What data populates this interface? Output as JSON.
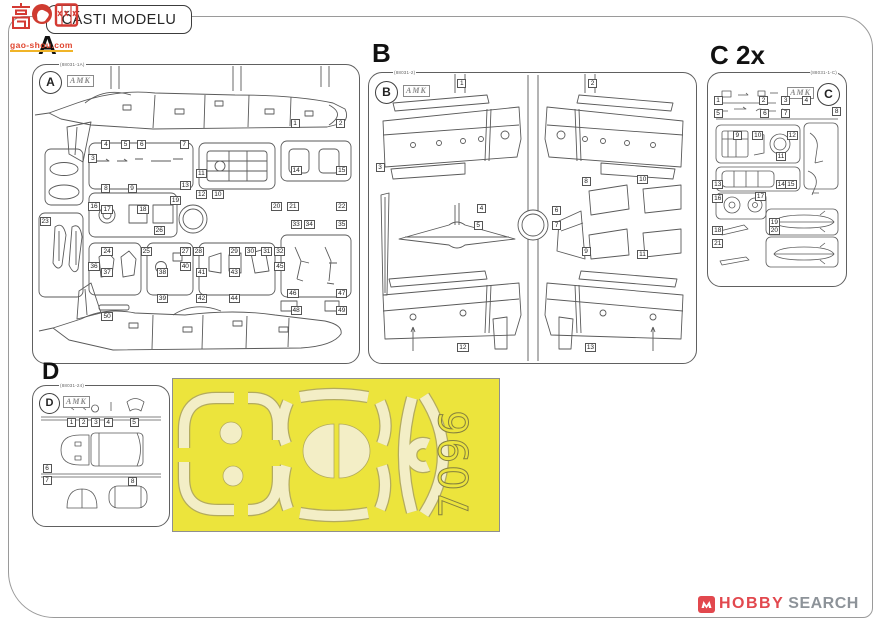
{
  "header": {
    "title": "ČÁSTI MODELU"
  },
  "watermark": {
    "chars": "高手网",
    "site": "gao-shou.com"
  },
  "mask": {
    "number": "7096",
    "color_bg": "#ece43c",
    "color_film": "#f3eec6"
  },
  "footer_logo": {
    "brand_primary": "HOBBY",
    "brand_secondary": "SEARCH",
    "icon": "hobbysearch-red-square-icon",
    "accent": "#e2484e"
  },
  "sprues": [
    {
      "id": "A",
      "label": "A",
      "code": "(88031-1A)",
      "logo": "AMK",
      "parts": [
        {
          "n": "1",
          "x": 79,
          "y": 18
        },
        {
          "n": "2",
          "x": 93,
          "y": 18
        },
        {
          "n": "3",
          "x": 17,
          "y": 30
        },
        {
          "n": "4",
          "x": 21,
          "y": 25
        },
        {
          "n": "5",
          "x": 27,
          "y": 25
        },
        {
          "n": "6",
          "x": 32,
          "y": 25
        },
        {
          "n": "7",
          "x": 45,
          "y": 25
        },
        {
          "n": "8",
          "x": 21,
          "y": 40
        },
        {
          "n": "9",
          "x": 29,
          "y": 40
        },
        {
          "n": "10",
          "x": 55,
          "y": 42
        },
        {
          "n": "11",
          "x": 50,
          "y": 35
        },
        {
          "n": "12",
          "x": 50,
          "y": 42
        },
        {
          "n": "13",
          "x": 45,
          "y": 39
        },
        {
          "n": "14",
          "x": 79,
          "y": 34
        },
        {
          "n": "15",
          "x": 93,
          "y": 34
        },
        {
          "n": "16",
          "x": 17,
          "y": 46
        },
        {
          "n": "17",
          "x": 21,
          "y": 47
        },
        {
          "n": "18",
          "x": 32,
          "y": 47
        },
        {
          "n": "19",
          "x": 42,
          "y": 44
        },
        {
          "n": "20",
          "x": 73,
          "y": 46
        },
        {
          "n": "21",
          "x": 78,
          "y": 46
        },
        {
          "n": "22",
          "x": 93,
          "y": 46
        },
        {
          "n": "23",
          "x": 2,
          "y": 51
        },
        {
          "n": "24",
          "x": 21,
          "y": 61
        },
        {
          "n": "25",
          "x": 33,
          "y": 61
        },
        {
          "n": "26",
          "x": 37,
          "y": 54
        },
        {
          "n": "27",
          "x": 45,
          "y": 61
        },
        {
          "n": "28",
          "x": 49,
          "y": 61
        },
        {
          "n": "29",
          "x": 60,
          "y": 61
        },
        {
          "n": "30",
          "x": 65,
          "y": 61
        },
        {
          "n": "31",
          "x": 70,
          "y": 61
        },
        {
          "n": "32",
          "x": 74,
          "y": 61
        },
        {
          "n": "33",
          "x": 79,
          "y": 52
        },
        {
          "n": "34",
          "x": 83,
          "y": 52
        },
        {
          "n": "35",
          "x": 93,
          "y": 52
        },
        {
          "n": "36",
          "x": 17,
          "y": 66
        },
        {
          "n": "37",
          "x": 21,
          "y": 68
        },
        {
          "n": "38",
          "x": 38,
          "y": 68
        },
        {
          "n": "39",
          "x": 38,
          "y": 77
        },
        {
          "n": "40",
          "x": 45,
          "y": 66
        },
        {
          "n": "41",
          "x": 50,
          "y": 68
        },
        {
          "n": "42",
          "x": 50,
          "y": 77
        },
        {
          "n": "43",
          "x": 60,
          "y": 68
        },
        {
          "n": "44",
          "x": 60,
          "y": 77
        },
        {
          "n": "45",
          "x": 74,
          "y": 66
        },
        {
          "n": "46",
          "x": 78,
          "y": 75
        },
        {
          "n": "47",
          "x": 93,
          "y": 75
        },
        {
          "n": "48",
          "x": 79,
          "y": 81
        },
        {
          "n": "49",
          "x": 93,
          "y": 81
        },
        {
          "n": "50",
          "x": 21,
          "y": 83
        }
      ]
    },
    {
      "id": "B",
      "label": "B",
      "code": "(88031-2)",
      "logo": "AMK",
      "parts": [
        {
          "n": "1",
          "x": 27,
          "y": 2
        },
        {
          "n": "2",
          "x": 67,
          "y": 2
        },
        {
          "n": "3",
          "x": 2,
          "y": 31
        },
        {
          "n": "4",
          "x": 33,
          "y": 45
        },
        {
          "n": "5",
          "x": 32,
          "y": 51
        },
        {
          "n": "6",
          "x": 56,
          "y": 46
        },
        {
          "n": "7",
          "x": 56,
          "y": 51
        },
        {
          "n": "8",
          "x": 65,
          "y": 36
        },
        {
          "n": "9",
          "x": 65,
          "y": 60
        },
        {
          "n": "10",
          "x": 82,
          "y": 35
        },
        {
          "n": "11",
          "x": 82,
          "y": 61
        },
        {
          "n": "12",
          "x": 27,
          "y": 93
        },
        {
          "n": "13",
          "x": 66,
          "y": 93
        }
      ]
    },
    {
      "id": "C",
      "label": "C 2x",
      "code": "(88031-1-C)",
      "logo": "AMK",
      "parts": [
        {
          "n": "1",
          "x": 4,
          "y": 11
        },
        {
          "n": "2",
          "x": 37,
          "y": 11
        },
        {
          "n": "3",
          "x": 53,
          "y": 11
        },
        {
          "n": "4",
          "x": 68,
          "y": 11
        },
        {
          "n": "5",
          "x": 4,
          "y": 17
        },
        {
          "n": "6",
          "x": 38,
          "y": 17
        },
        {
          "n": "7",
          "x": 53,
          "y": 17
        },
        {
          "n": "8",
          "x": 90,
          "y": 16
        },
        {
          "n": "9",
          "x": 18,
          "y": 27
        },
        {
          "n": "10",
          "x": 32,
          "y": 27
        },
        {
          "n": "11",
          "x": 49,
          "y": 37
        },
        {
          "n": "12",
          "x": 57,
          "y": 27
        },
        {
          "n": "13",
          "x": 3,
          "y": 50
        },
        {
          "n": "14",
          "x": 49,
          "y": 50
        },
        {
          "n": "15",
          "x": 56,
          "y": 50
        },
        {
          "n": "16",
          "x": 3,
          "y": 57
        },
        {
          "n": "17",
          "x": 34,
          "y": 56
        },
        {
          "n": "18",
          "x": 3,
          "y": 72
        },
        {
          "n": "19",
          "x": 44,
          "y": 68
        },
        {
          "n": "20",
          "x": 44,
          "y": 72
        },
        {
          "n": "21",
          "x": 3,
          "y": 78
        }
      ]
    },
    {
      "id": "D",
      "label": "D",
      "code": "(88031-24)",
      "logo": "AMK",
      "parts": [
        {
          "n": "1",
          "x": 25,
          "y": 23
        },
        {
          "n": "2",
          "x": 34,
          "y": 23
        },
        {
          "n": "3",
          "x": 43,
          "y": 23
        },
        {
          "n": "4",
          "x": 52,
          "y": 23
        },
        {
          "n": "5",
          "x": 71,
          "y": 23
        },
        {
          "n": "6",
          "x": 7,
          "y": 56
        },
        {
          "n": "7",
          "x": 7,
          "y": 64
        },
        {
          "n": "8",
          "x": 70,
          "y": 65
        }
      ]
    }
  ]
}
